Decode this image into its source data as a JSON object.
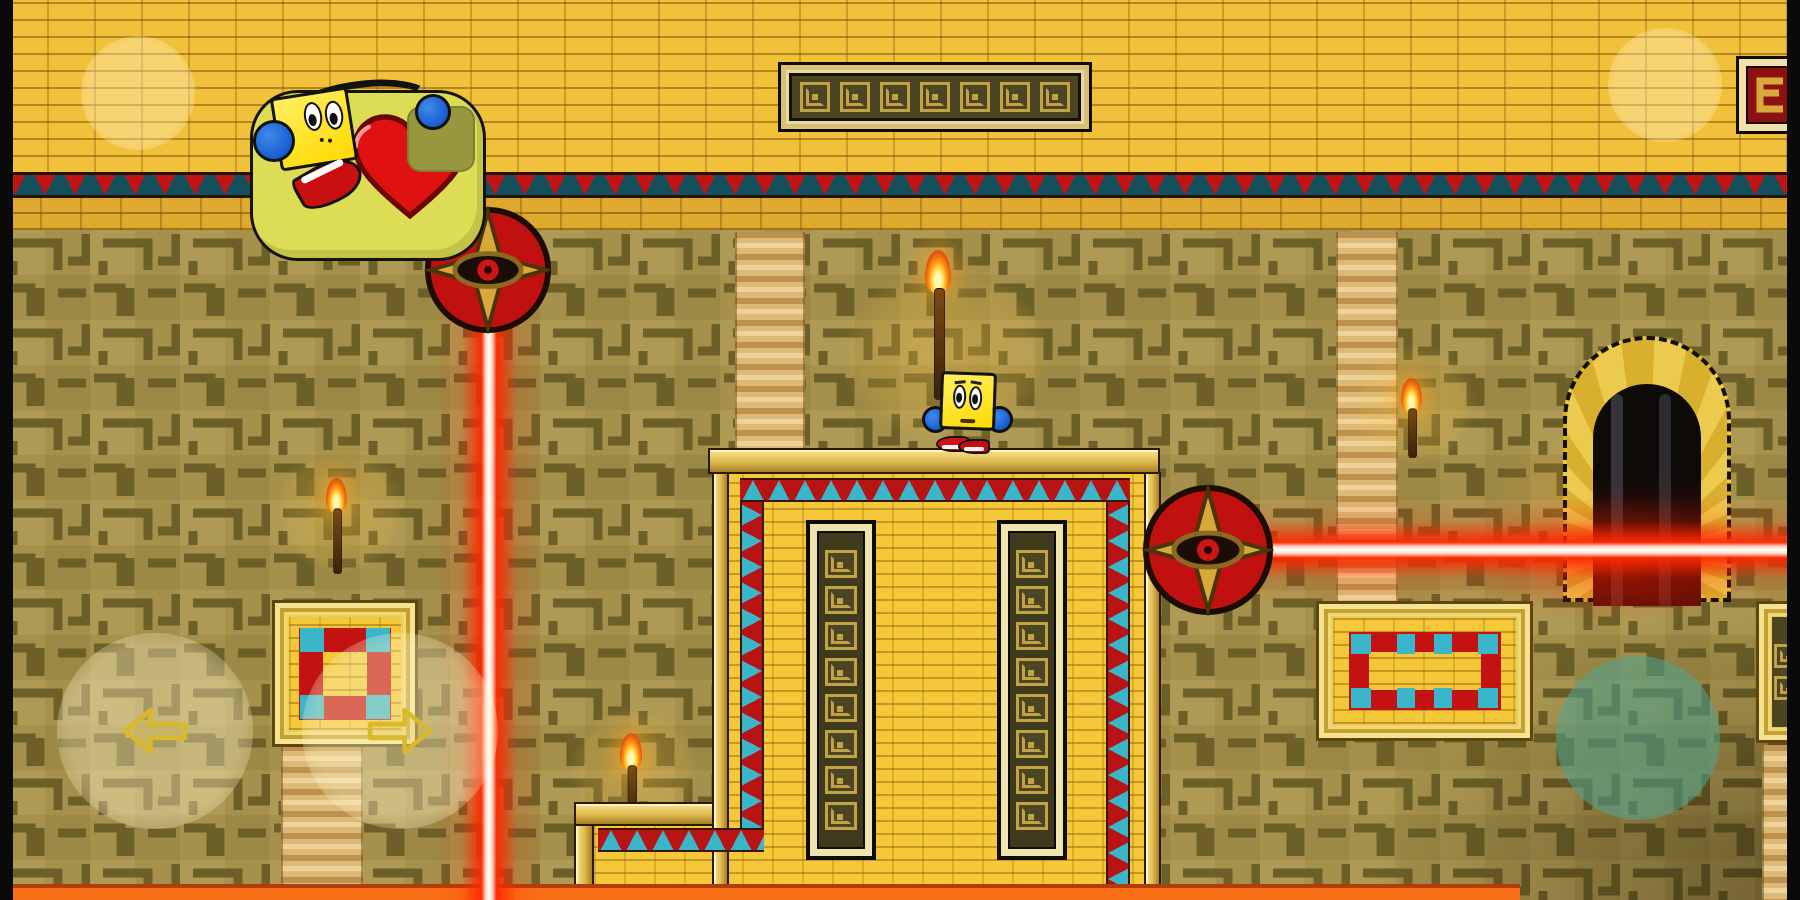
{
  "meta": {
    "type": "game-screenshot",
    "game_style": "pac-man style maze platformer",
    "theme": "egyptian temple interior",
    "resolution": "1800x900",
    "visible_text": ""
  },
  "palette": {
    "wall_brick": "#f2c13c",
    "maze_background": "#a5914b",
    "maze_line": "#6c6028",
    "gold_beam": "#ddb84e",
    "border_red": "#c01414",
    "border_teal": "#3ab5c9",
    "laser_core": "#ffffff",
    "laser_glow": "#ff2800",
    "floor_lava": "#f97016",
    "bubble_fill": "#dcdc55",
    "heart_red": "#df1111",
    "character_yellow": "#ffe41c",
    "headphone_blue": "#1c64d6",
    "doorway_dark": "#0d0a08"
  },
  "entities": {
    "player_large": {
      "description": "big yellow square-headed character with blue headphones, screaming with red open mouth",
      "position": "top-left on wall ledge",
      "speech_bubble": {
        "shape": "rounded-blob",
        "icon": "red-heart-with-bite-missing"
      }
    },
    "player_small": {
      "description": "small yellow square-headed character with blue headphones and red sneakers",
      "position": "standing on central monument top"
    },
    "laser_traps": [
      {
        "orientation": "vertical",
        "emitter": "gold eye-star emblem on red disc",
        "origin": "under top wall ledge"
      },
      {
        "orientation": "horizontal",
        "emitter": "gold eye-star emblem on red disc",
        "origin": "right side of central monument"
      }
    ]
  },
  "environment": {
    "doorway": {
      "type": "arched portal",
      "state": "dark opening",
      "location": "right wall"
    },
    "central_monument": {
      "glyph_panels": 2,
      "border": "red-teal triangle trim",
      "step": "lower-left"
    },
    "torch_count": 4,
    "column_count": 4,
    "plaques": [
      "top banner with greek-key glyph row",
      "square plaque with red ring and teal corners (left wall)",
      "rectangular plaque with red-teal ring (right wall)",
      "red snake-glyph plaque (top-right edge)",
      "glyph plaque (bottom-right edge)"
    ]
  },
  "decorations": {
    "banner_glyph_count": 7,
    "panel_glyph_count": 8,
    "edge_plaque_glyph_count": 2
  },
  "controls": {
    "move_left": {
      "glyph": "left-arrow-outline"
    },
    "move_right": {
      "glyph": "right-arrow-outline"
    },
    "action": {
      "glyph": "none",
      "color": "teal"
    },
    "ghost_button_top_left": {
      "glyph": "faint-circle"
    },
    "ghost_button_top_right": {
      "glyph": "faint-circle"
    }
  }
}
